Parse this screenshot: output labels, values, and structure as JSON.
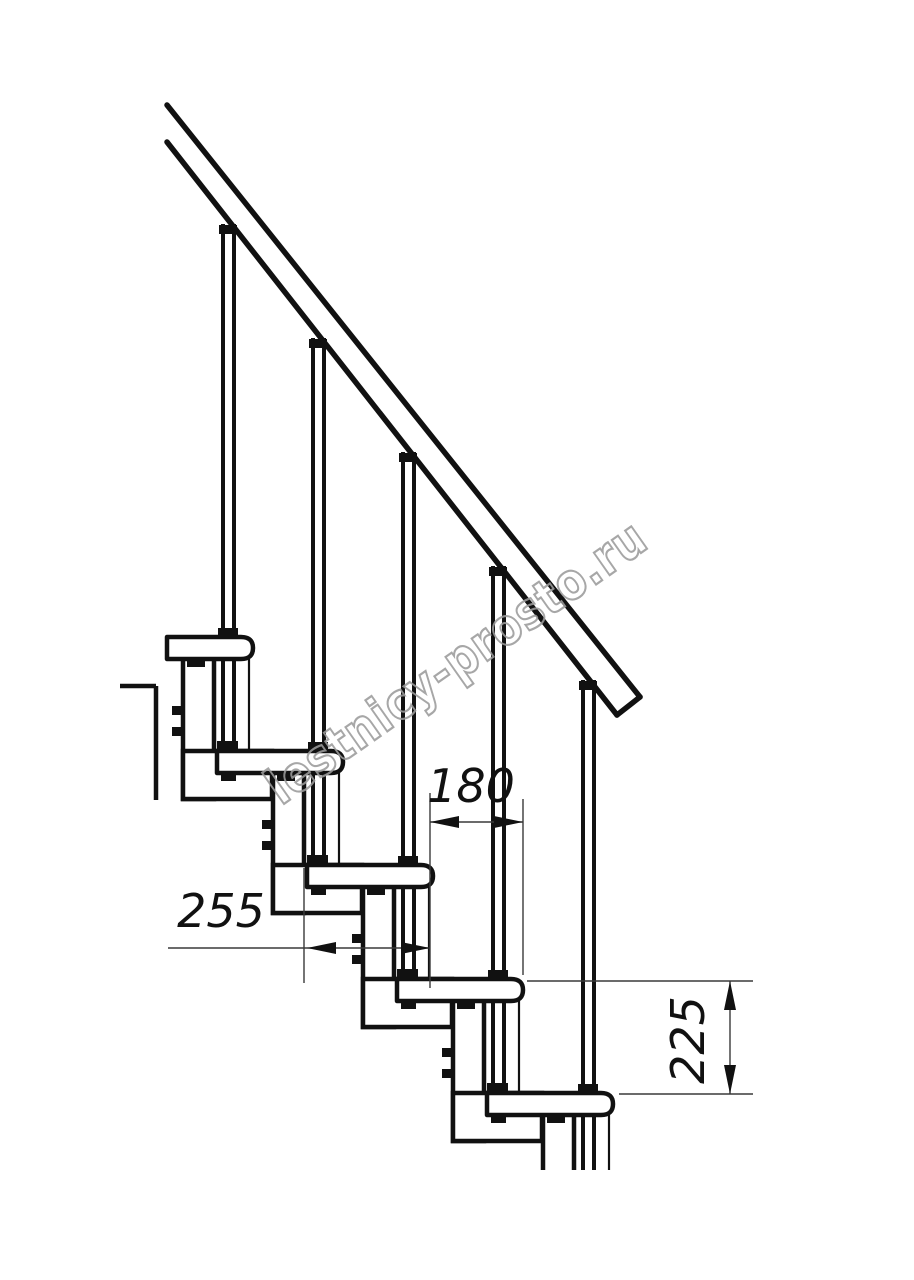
{
  "watermark": {
    "text": "lestnicy-prosto.ru",
    "color": "#9b9b9b"
  },
  "dimensions": {
    "step_run": {
      "value": "180",
      "orientation": "horizontal"
    },
    "tread_depth": {
      "value": "255",
      "orientation": "horizontal"
    },
    "step_rise": {
      "value": "225",
      "orientation": "vertical"
    }
  },
  "stair": {
    "visible_steps": 5,
    "visible_balusters": 5,
    "has_handrail": true
  },
  "colors": {
    "background": "#ffffff",
    "line": "#111111",
    "dimension_line": "#3a3a3a",
    "watermark": "#9b9b9b"
  }
}
